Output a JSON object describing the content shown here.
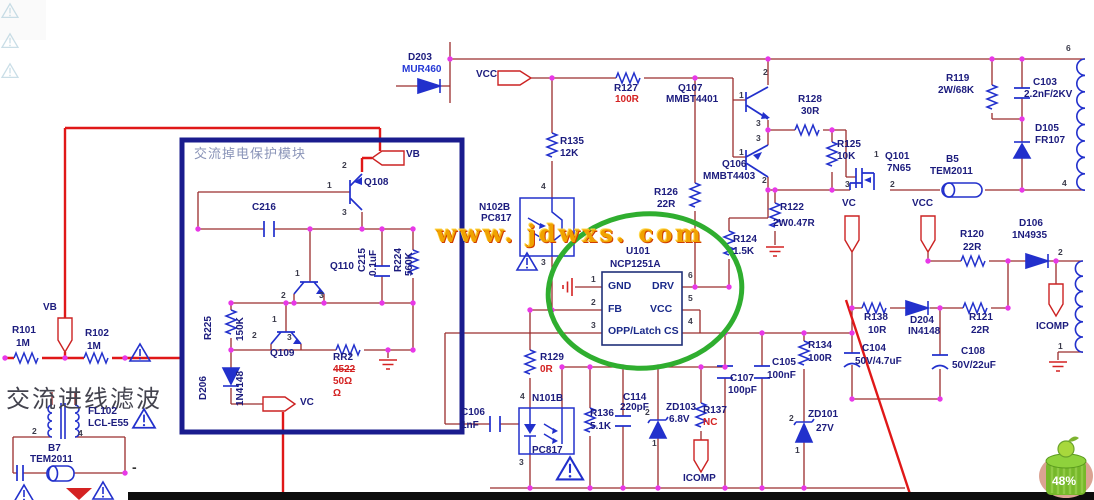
{
  "watermark": "www. jdwxs. com",
  "battery_pct": "48%",
  "module": {
    "title": "交流掉电保护模块"
  },
  "texts": {
    "ac_filter": "交流进线滤波"
  },
  "flags": {
    "vb": "VB",
    "vc": "VC",
    "vcc": "VCC",
    "icomp": "ICOMP"
  },
  "P": {
    "n1": "1",
    "n2": "2",
    "n3": "3",
    "n4": "4",
    "n5": "5",
    "n6": "6"
  },
  "U": {
    "ref": "U101",
    "part": "NCP1251A",
    "gnd": "GND",
    "fb": "FB",
    "opp": "OPP/Latch",
    "drv": "DRV",
    "vcc": "VCC",
    "cs": "CS"
  },
  "L": {
    "d203": "D203",
    "d203v": "MUR460",
    "r127": "R127",
    "v100r": "100R",
    "q107": "Q107",
    "q107v": "MMBT4401",
    "r135": "R135",
    "r135v": "12K",
    "n102b": "N102B",
    "pc817": "PC817",
    "q106": "Q106",
    "q106v": "MMBT4403",
    "r128": "R128",
    "r128v": "30R",
    "r125": "R125",
    "r125v": "10K",
    "q101": "Q101",
    "q101v": "7N65",
    "b5": "B5",
    "tem2011": "TEM2011",
    "r119": "R119",
    "r119v": "2W/68K",
    "c103": "C103",
    "c103v": "2.2nF/2KV",
    "d105": "D105",
    "d105v": "FR107",
    "r126": "R126",
    "v22r": "22R",
    "r124": "R124",
    "r124v": "1.5K",
    "r122": "R122",
    "r122v": "2W0.47R",
    "r120": "R120",
    "d106": "D106",
    "d106v": "1N4935",
    "r138": "R138",
    "r138v": "10R",
    "d204": "D204",
    "d204v": "IN4148",
    "r121": "R121",
    "c108": "C108",
    "c108v": "50V/22uF",
    "c104": "C104",
    "c104v": "50V/4.7uF",
    "r134": "R134",
    "c105": "C105",
    "c105v": "100nF",
    "c107": "C107",
    "c107v": "100pF",
    "zd101": "ZD101",
    "zd101v": "27V",
    "r129": "R129",
    "r129v": "0R",
    "c106": "C106",
    "c106v": "1nF",
    "n101b": "N101B",
    "r136": "R136",
    "r136v": "5.1K",
    "c114": "C114",
    "c114v": "220pF",
    "zd103": "ZD103",
    "zd103v": "6.8V",
    "r137": "R137",
    "nc": "NC",
    "q108": "Q108",
    "c216": "C216",
    "q110": "Q110",
    "c215": "C215",
    "c215v": "0.1uF",
    "r224": "R224",
    "r224v": "560K",
    "r225": "R225",
    "r225v": "150K",
    "q109": "Q109",
    "rr2": "RR2",
    "rr2a": "4522",
    "rr2b": "50Ω",
    "rr2c": "Ω",
    "d206": "D206",
    "d206v": "1N4148",
    "r101": "R101",
    "r102": "R102",
    "v1m": "1M",
    "fl102": "FL102",
    "fl102v": "LCL-E55",
    "b7": "B7",
    "minus": "-"
  },
  "colors": {
    "wire": "#9a2d2d",
    "power_red": "#e01818",
    "component_blue": "#2230cc",
    "junction": "#e838e8",
    "module_border": "#1a1c8e",
    "highlight_green": "#2fae2f",
    "watermark_gold": "#f0a200",
    "value_red": "#d42222",
    "label_navy": "#1c1c7e"
  }
}
